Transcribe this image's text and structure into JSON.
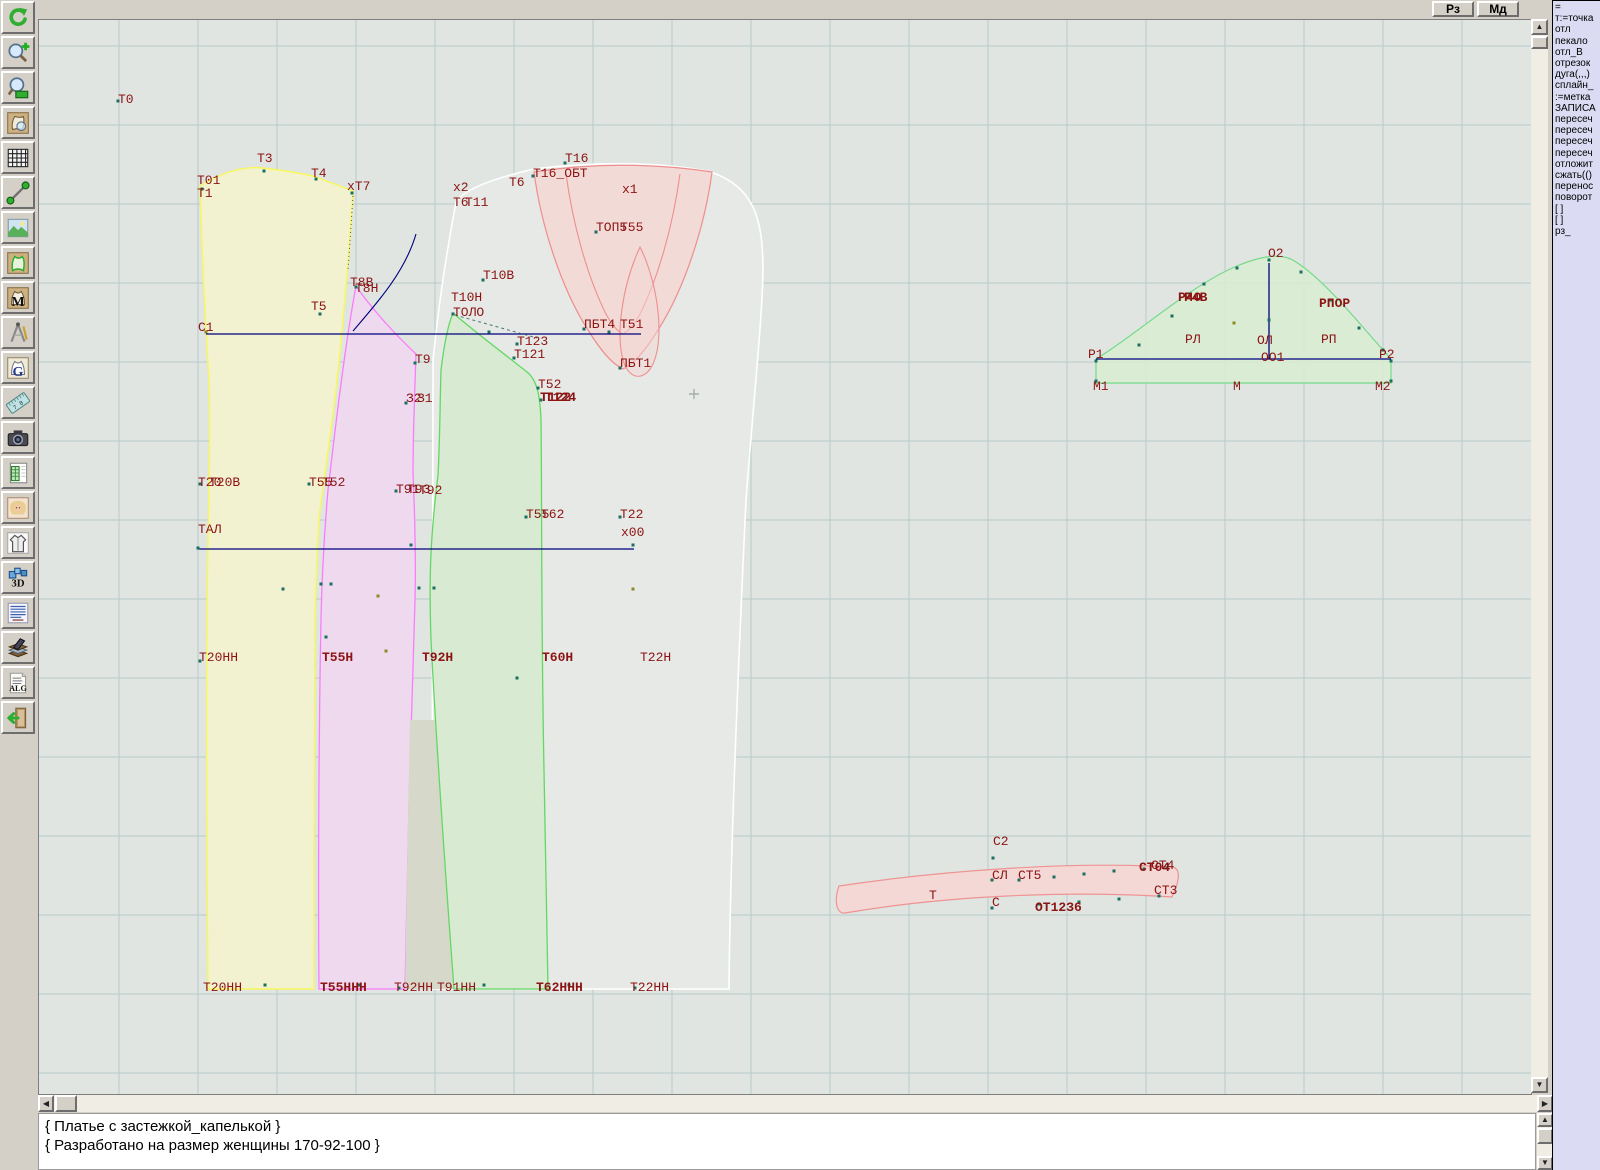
{
  "topbar": {
    "buttons": [
      {
        "label": "Рз"
      },
      {
        "label": "Мд"
      }
    ]
  },
  "toolbar": {
    "items": [
      {
        "name": "undo"
      },
      {
        "name": "zoom-in"
      },
      {
        "name": "zoom-window"
      },
      {
        "name": "piece-preview"
      },
      {
        "name": "grid"
      },
      {
        "name": "measure"
      },
      {
        "name": "image"
      },
      {
        "name": "pattern"
      },
      {
        "name": "pattern-m"
      },
      {
        "name": "compass"
      },
      {
        "name": "pattern-g"
      },
      {
        "name": "ruler"
      },
      {
        "name": "camera"
      },
      {
        "name": "table"
      },
      {
        "name": "model-photo"
      },
      {
        "name": "garment"
      },
      {
        "name": "view-3d"
      },
      {
        "name": "text-list"
      },
      {
        "name": "books"
      },
      {
        "name": "alg"
      },
      {
        "name": "exit"
      }
    ]
  },
  "right_panel": {
    "lines": [
      "=",
      "т:=точка",
      "отл",
      "пекало",
      "отл_В",
      "отрезок",
      "дуга(,,,)",
      "сплайн_",
      ":=метка",
      "ЗАПИСА",
      "пересеч",
      "пересеч",
      "пересеч",
      "пересеч",
      "отложит",
      "сжать(()",
      "перенос",
      "поворот",
      "[ ]",
      "[ ]",
      "рз_"
    ]
  },
  "statusbar": {
    "lines": [
      "{ Платье с застежкой_капелькой }",
      "{ Разработано на размер женщины 170-92-100 }"
    ]
  },
  "colors": {
    "canvas_bg": "#e0e5e1",
    "grid": "#b7cbc9",
    "label": "#8c1414",
    "yellow_fill": "#f2f2d0",
    "yellow_edge": "#f8f85a",
    "magenta_fill": "#eed9ee",
    "magenta_edge": "#fb7cfb",
    "green_fill": "#d9ead2",
    "green_edge": "#62d862",
    "red_fill": "#f3d8d4",
    "red_edge": "#ee8f8f",
    "white_fill": "#e6e9e5",
    "navy": "#00007d",
    "panel_bg": "#dbdbf3"
  },
  "canvas": {
    "labels": [
      {
        "t": "Т0",
        "x": 79,
        "y": 83
      },
      {
        "t": "Т3",
        "x": 218,
        "y": 142
      },
      {
        "t": "Т01",
        "x": 158,
        "y": 164
      },
      {
        "t": "Т1",
        "x": 158,
        "y": 177
      },
      {
        "t": "Т4",
        "x": 272,
        "y": 157
      },
      {
        "t": "хТ7",
        "x": 308,
        "y": 170
      },
      {
        "t": "х2",
        "x": 414,
        "y": 171
      },
      {
        "t": "Т6",
        "x": 414,
        "y": 186
      },
      {
        "t": "Т11",
        "x": 426,
        "y": 186
      },
      {
        "t": "Т6",
        "x": 470,
        "y": 166
      },
      {
        "t": "Т16",
        "x": 526,
        "y": 142
      },
      {
        "t": "Т16_ОБТ",
        "x": 494,
        "y": 157
      },
      {
        "t": "х1",
        "x": 583,
        "y": 173
      },
      {
        "t": "ТОП5",
        "x": 557,
        "y": 211
      },
      {
        "t": "Т55",
        "x": 581,
        "y": 211
      },
      {
        "t": "Т10В",
        "x": 444,
        "y": 259
      },
      {
        "t": "Т8В",
        "x": 311,
        "y": 266
      },
      {
        "t": "Т8Н",
        "x": 316,
        "y": 272
      },
      {
        "t": "Т5",
        "x": 272,
        "y": 290
      },
      {
        "t": "Т10Н",
        "x": 412,
        "y": 281
      },
      {
        "t": "ТОЛО",
        "x": 414,
        "y": 296
      },
      {
        "t": "С1",
        "x": 159,
        "y": 311
      },
      {
        "t": "ПБТ4",
        "x": 545,
        "y": 308
      },
      {
        "t": "Т51",
        "x": 581,
        "y": 308
      },
      {
        "t": "Т123",
        "x": 478,
        "y": 325
      },
      {
        "t": "Т121",
        "x": 475,
        "y": 338
      },
      {
        "t": "Т9",
        "x": 376,
        "y": 343
      },
      {
        "t": "ПБТ1",
        "x": 581,
        "y": 347
      },
      {
        "t": "Т52",
        "x": 499,
        "y": 368
      },
      {
        "t": "Т122",
        "x": 501,
        "y": 381,
        "b": 1
      },
      {
        "t": "Т124",
        "x": 506,
        "y": 381,
        "b": 1
      },
      {
        "t": "З2",
        "x": 367,
        "y": 382
      },
      {
        "t": "З1",
        "x": 378,
        "y": 382
      },
      {
        "t": "Т20",
        "x": 159,
        "y": 466
      },
      {
        "t": "Т20В",
        "x": 170,
        "y": 466
      },
      {
        "t": "Т55",
        "x": 270,
        "y": 466
      },
      {
        "t": "Т52",
        "x": 283,
        "y": 466
      },
      {
        "t": "Т91",
        "x": 357,
        "y": 473
      },
      {
        "t": "Т93",
        "x": 368,
        "y": 473
      },
      {
        "t": "Т92",
        "x": 380,
        "y": 474
      },
      {
        "t": "Т55",
        "x": 487,
        "y": 498
      },
      {
        "t": "Т62",
        "x": 502,
        "y": 498
      },
      {
        "t": "Т22",
        "x": 581,
        "y": 498
      },
      {
        "t": "ТАЛ",
        "x": 159,
        "y": 513
      },
      {
        "t": "х00",
        "x": 582,
        "y": 516
      },
      {
        "t": "Т20НН",
        "x": 160,
        "y": 641
      },
      {
        "t": "Т55Н",
        "x": 283,
        "y": 641,
        "b": 1
      },
      {
        "t": "Т92Н",
        "x": 383,
        "y": 641,
        "b": 1
      },
      {
        "t": "Т60Н",
        "x": 503,
        "y": 641,
        "b": 1
      },
      {
        "t": "Т22Н",
        "x": 601,
        "y": 641
      },
      {
        "t": "Т20НН",
        "x": 164,
        "y": 971
      },
      {
        "t": "Т55ННН",
        "x": 281,
        "y": 971,
        "b": 1
      },
      {
        "t": "Т92НН",
        "x": 355,
        "y": 971
      },
      {
        "t": "Т91НН",
        "x": 398,
        "y": 971
      },
      {
        "t": "Т62ННН",
        "x": 497,
        "y": 971,
        "b": 1
      },
      {
        "t": "Т22НН",
        "x": 591,
        "y": 971
      },
      {
        "t": "О2",
        "x": 1229,
        "y": 237
      },
      {
        "t": "Р4О",
        "x": 1139,
        "y": 281,
        "b": 1
      },
      {
        "t": "Р4В",
        "x": 1145,
        "y": 281,
        "b": 1
      },
      {
        "t": "РПОР",
        "x": 1280,
        "y": 287,
        "b": 1
      },
      {
        "t": "РЛ",
        "x": 1146,
        "y": 323
      },
      {
        "t": "ОЛ",
        "x": 1218,
        "y": 324
      },
      {
        "t": "РП",
        "x": 1282,
        "y": 323
      },
      {
        "t": "Р1",
        "x": 1049,
        "y": 338
      },
      {
        "t": "ОО1",
        "x": 1222,
        "y": 341
      },
      {
        "t": "Р2",
        "x": 1340,
        "y": 338
      },
      {
        "t": "М1",
        "x": 1054,
        "y": 370
      },
      {
        "t": "М",
        "x": 1194,
        "y": 370
      },
      {
        "t": "М2",
        "x": 1336,
        "y": 370
      },
      {
        "t": "С2",
        "x": 954,
        "y": 825
      },
      {
        "t": "СЛ",
        "x": 953,
        "y": 859
      },
      {
        "t": "СТ5",
        "x": 979,
        "y": 859
      },
      {
        "t": "СТ04",
        "x": 1100,
        "y": 851,
        "b": 1
      },
      {
        "t": "СТ4",
        "x": 1112,
        "y": 849
      },
      {
        "t": "СТ3",
        "x": 1115,
        "y": 874
      },
      {
        "t": "Т",
        "x": 890,
        "y": 879
      },
      {
        "t": "С",
        "x": 953,
        "y": 886
      },
      {
        "t": "ОТ12З6",
        "x": 996,
        "y": 891,
        "b": 1
      }
    ]
  }
}
